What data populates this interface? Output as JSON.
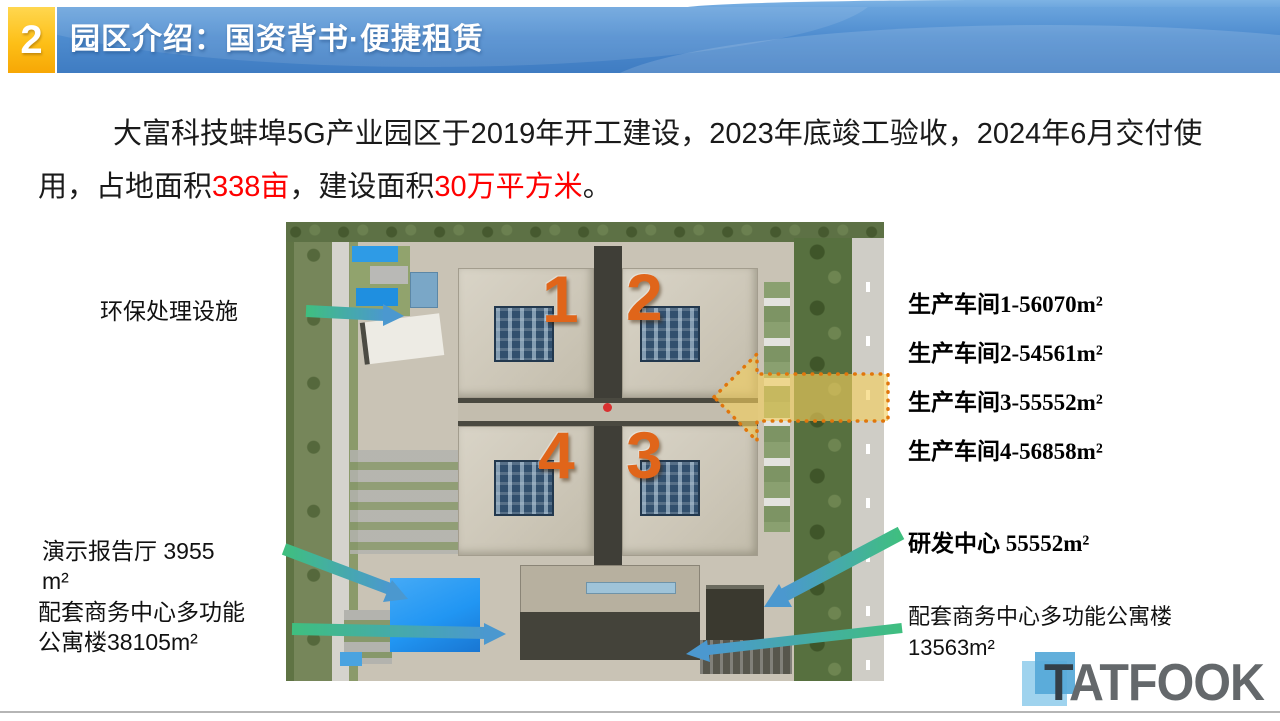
{
  "header": {
    "badge": "2",
    "title": "园区介绍：国资背书·便捷租赁"
  },
  "intro": {
    "p1": "大富科技蚌埠5G产业园区于2019年开工建设，2023年底竣工验收，2024年6月交付使用，占地面积",
    "p2": "338亩",
    "p3": "，建设面积",
    "p4": "30万平方米",
    "p5": "。"
  },
  "photo": {
    "building_numbers": [
      "1",
      "2",
      "4",
      "3"
    ]
  },
  "left_labels": {
    "env": "环保处理设施",
    "hall_line1": "演示报告厅 3955",
    "hall_line2": "m²",
    "apartment_line1": "配套商务中心多功能",
    "apartment_line2": "公寓楼38105m²"
  },
  "right_labels": {
    "workshops": [
      "生产车间1-56070m²",
      "生产车间2-54561m²",
      "生产车间3-55552m²",
      "生产车间4-56858m²"
    ],
    "rd_center": "研发中心 55552m²",
    "apartment_line1": "配套商务中心多功能公寓楼",
    "apartment_line2": "13563m²"
  },
  "logo": {
    "t": "T",
    "rest": "ATFOOK"
  },
  "colors": {
    "header_blue": "#4e8ccf",
    "badge_yellow": "#fdbf17",
    "highlight_red": "#ff0000",
    "number_orange": "#e0651a",
    "arrow_green": "#3fbf7f",
    "arrow_blue": "#4b98cf",
    "dotted_arrow_fill": "#f4ce5c",
    "dotted_arrow_border": "#e0760c"
  }
}
